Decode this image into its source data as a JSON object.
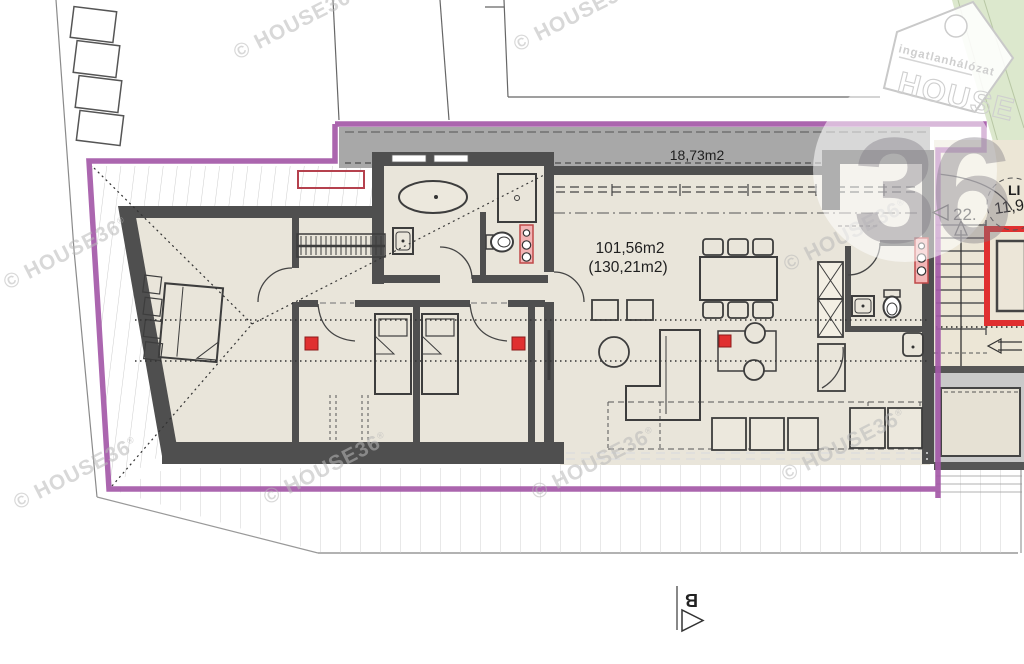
{
  "areas": {
    "terrace": "18,73m2",
    "apartment_net": "101,56m2",
    "apartment_gross": "(130,21m2)",
    "stair_count": "22.",
    "stair_area_partial": "11,9",
    "lift_label_partial": "LI"
  },
  "section_marker": {
    "letter": "B"
  },
  "watermark": {
    "text": "© HOUSE36",
    "registered": "®"
  },
  "logo": {
    "tagline": "ingatlanhálózat",
    "brand": "HOUSE",
    "number": "36"
  },
  "colors": {
    "boundary_purple": "#a459a8",
    "wall_gray": "#4f4f4f",
    "floor_beige": "#e9e5da",
    "terrace_gray": "#a8a8a8",
    "accent_red": "#e03030",
    "plumbing_pink": "#f2b5b5",
    "green_area": "#dce8cd",
    "watermark_gray": "#b9b9b9"
  }
}
